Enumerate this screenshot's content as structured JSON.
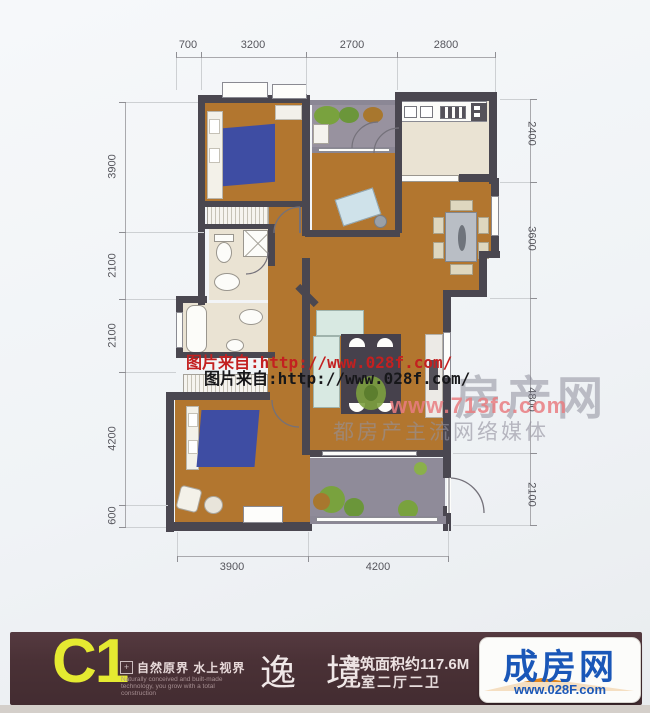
{
  "plan": {
    "dimensions": {
      "top": [
        "700",
        "3200",
        "2700",
        "2800"
      ],
      "left": [
        "3900",
        "2100",
        "2100",
        "4200",
        "600"
      ],
      "right": [
        "2400",
        "3600",
        "4800",
        "2100"
      ],
      "bottom": [
        "3900",
        "4200"
      ]
    }
  },
  "watermarks": {
    "photo_credit_line1": "图片来自:http://www.028f.com/",
    "photo_credit_line2": "图片来自:http://www.028f.com/",
    "site_name": "房产网",
    "site_url": "www.713fc.com",
    "site_slogan": "都房产主流网络媒体"
  },
  "footer": {
    "unit_code": "C1",
    "tagline_cn": "自然原界  水上视界",
    "tagline_en_line1": "Naturally conceived and built-made",
    "tagline_en_line2": "technology, you grow with a total",
    "tagline_en_line3": "construction",
    "unit_name": "逸 境",
    "area_text": "建筑面积约117.6M",
    "layout_text": "三室二厅二卫",
    "logo_name": "成房网",
    "logo_url": "www.028F.com"
  },
  "colors": {
    "floor_orange": "#b2762f",
    "wall_dark": "#4a4750",
    "bath_floor": "#eae3d3",
    "balcony_floor": "#94909e",
    "bed_blue": "#3e4da3",
    "sofa_mint": "#d8e9e2",
    "accent_yellow": "#e5ea31",
    "footer_bg": "#4a3136",
    "logo_blue": "#1a57b8",
    "watermark_red": "#c32020",
    "watermark_pink": "#e97c80"
  }
}
